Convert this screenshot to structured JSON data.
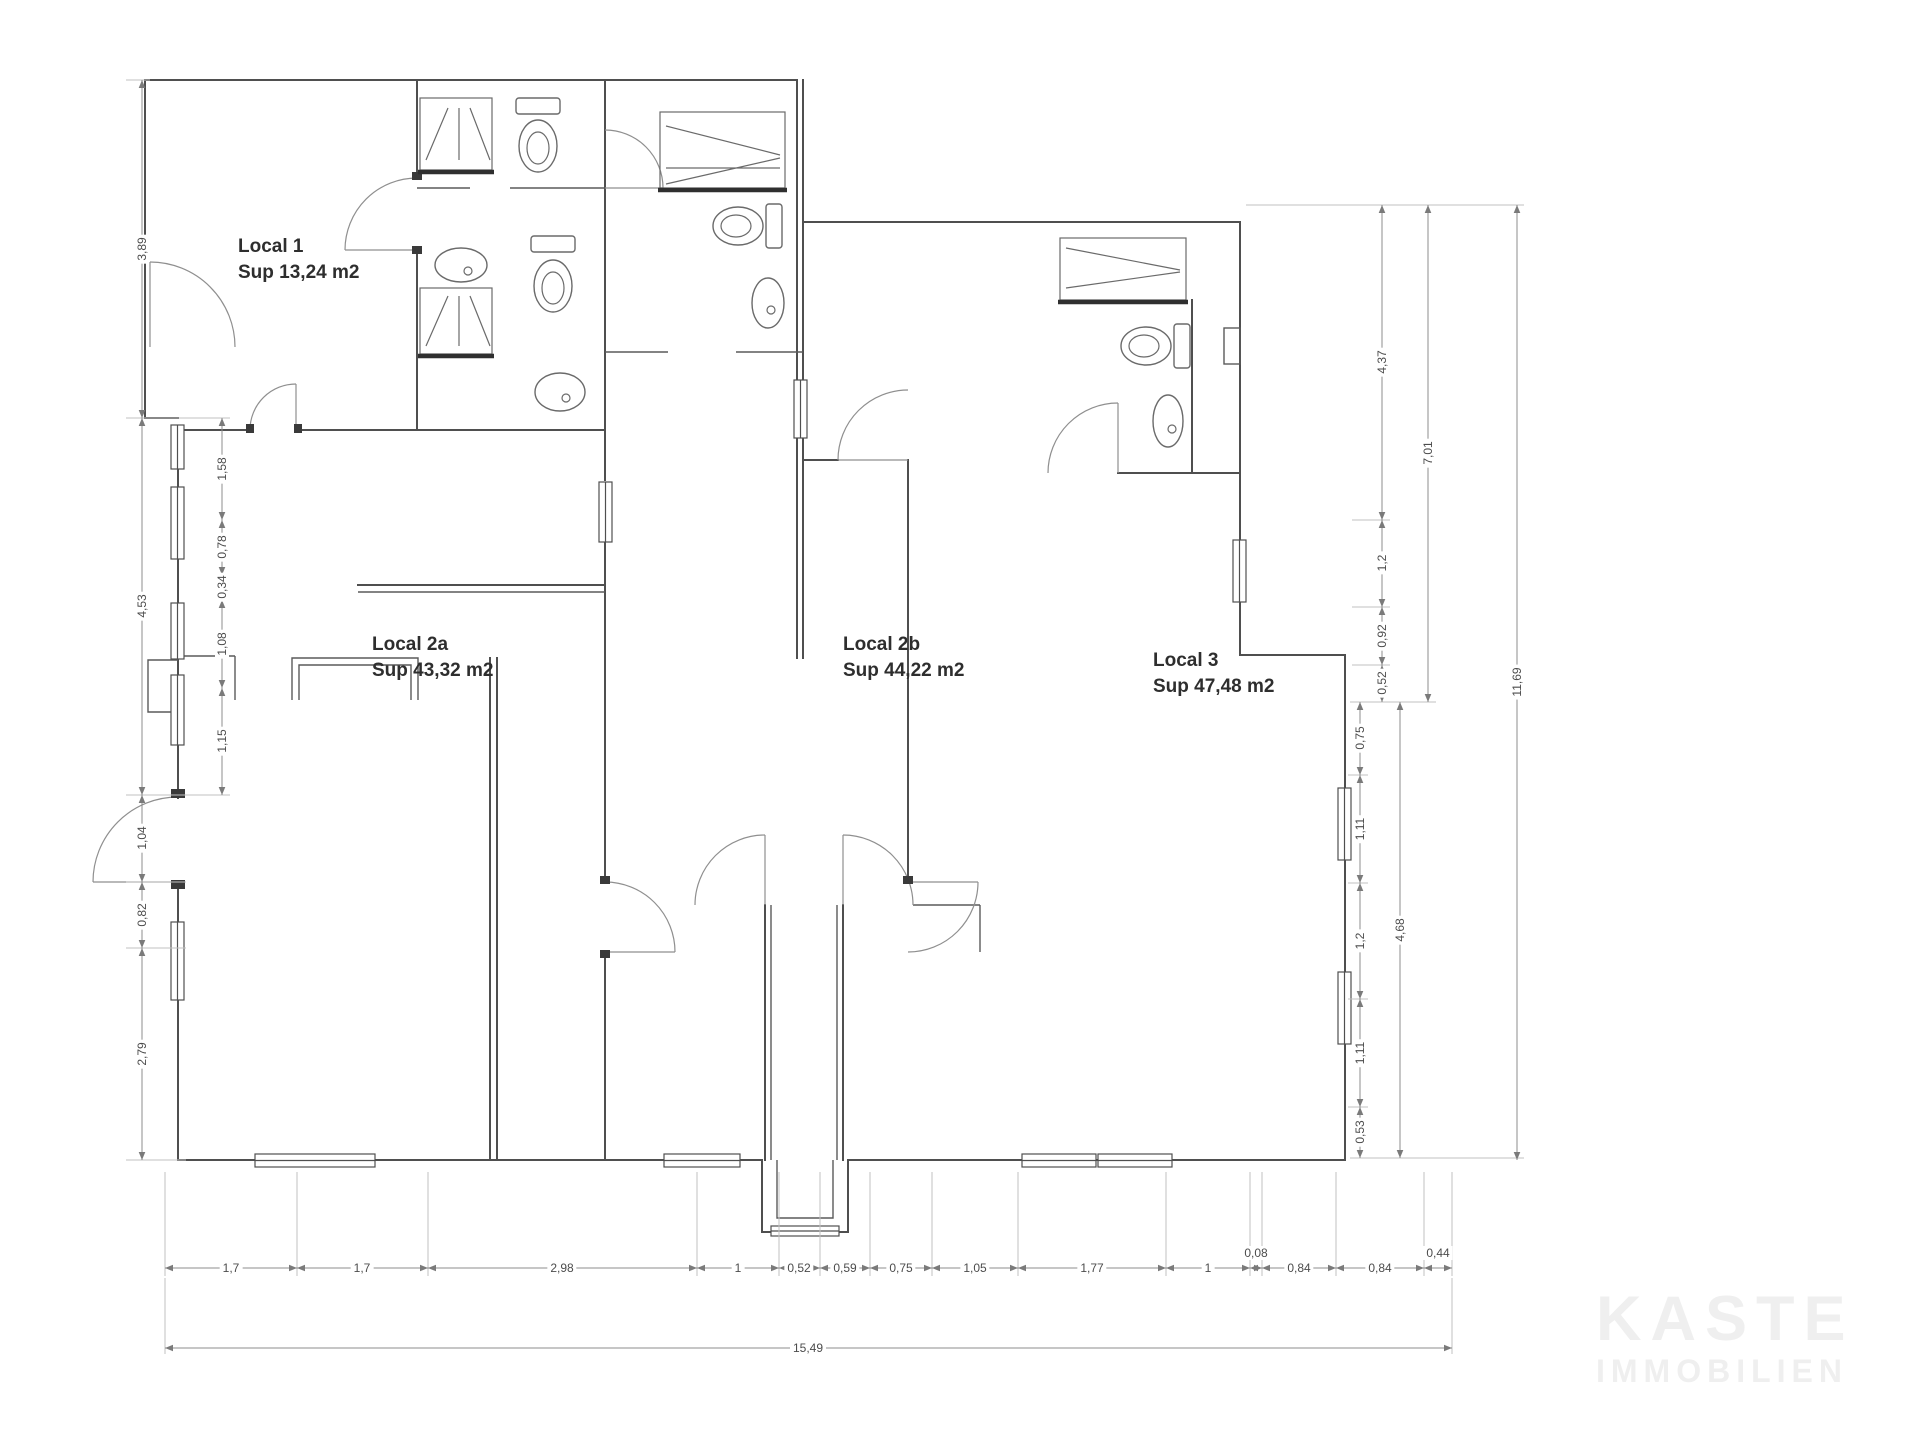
{
  "plan_title": "Floor plan with three commercial units",
  "colors": {
    "background": "#ffffff",
    "wall": "#4f4f4f",
    "dimension_line": "#8c8c8c",
    "label_text": "#2e2e2e",
    "watermark": "#efefef"
  },
  "rooms": [
    {
      "name": "Local 1",
      "area": "Sup 13,24 m2"
    },
    {
      "name": "Local 2a",
      "area": "Sup 43,32 m2"
    },
    {
      "name": "Local 2b",
      "area": "Sup 44,22 m2"
    },
    {
      "name": "Local 3",
      "area": "Sup 47,48 m2"
    }
  ],
  "dims_bottom": [
    "1,7",
    "1,7",
    "2,98",
    "1",
    "0,52",
    "0,59",
    "0,75",
    "1,05",
    "1,77",
    "1",
    "0,08",
    "0,84",
    "0,84",
    "0,44"
  ],
  "dims_bottom_total": "15,49",
  "dims_left": [
    "3,89",
    "4,53",
    "1,04",
    "0,82",
    "2,79",
    "1,58",
    "0,78",
    "0,34",
    "1,08",
    "1,15"
  ],
  "dims_right": [
    "4,37",
    "1,2",
    "0,92",
    "0,52",
    "7,01",
    "11,69",
    "0,75",
    "1,11",
    "1,2",
    "1,11",
    "0,53",
    "4,68"
  ],
  "icons": {
    "shower": "shower-icon",
    "toilet": "toilet-icon",
    "sink": "sink-icon",
    "door": "door-arc"
  },
  "watermark": {
    "line1": "KASTE",
    "line2": "IMMOBILIEN"
  }
}
